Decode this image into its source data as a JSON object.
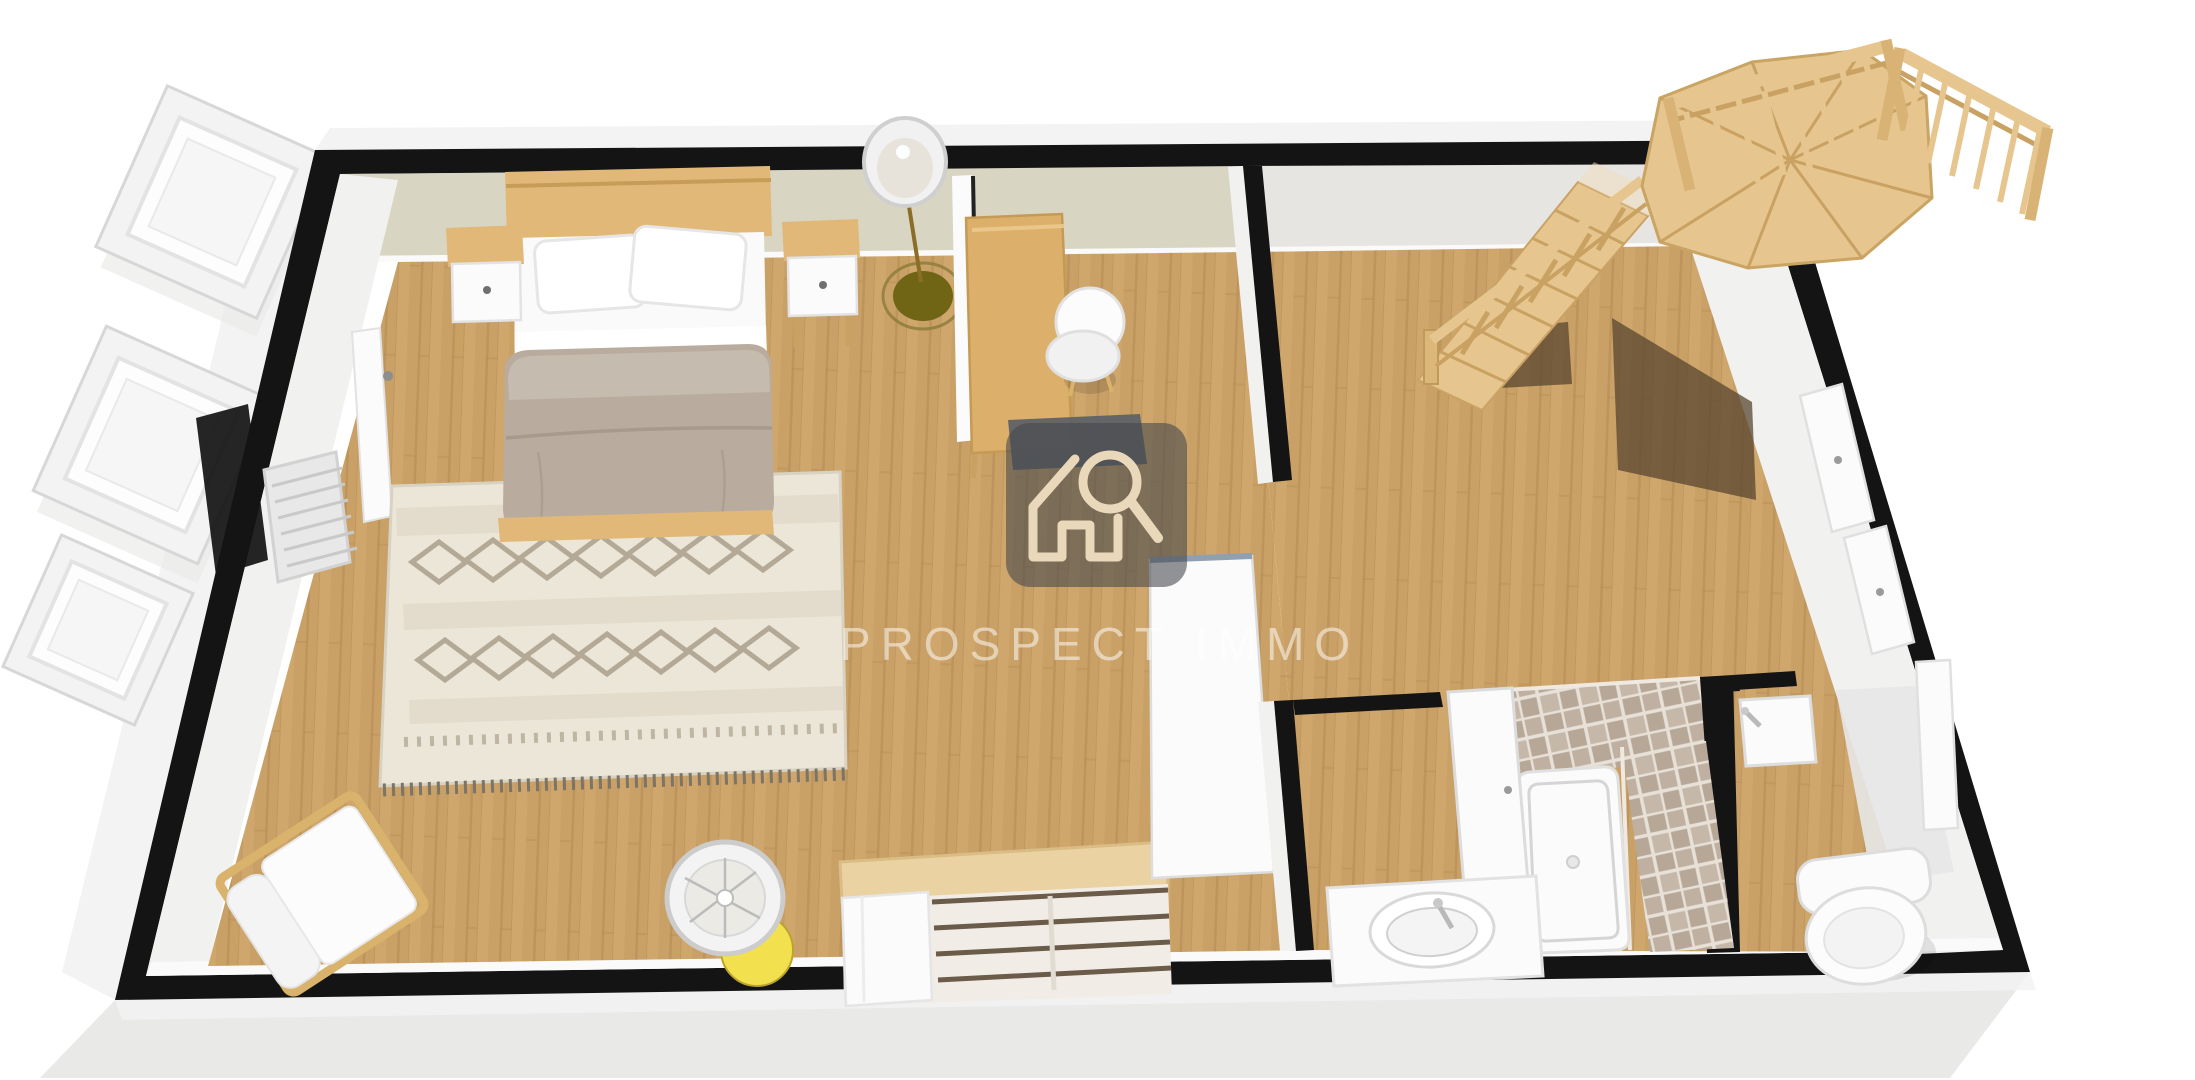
{
  "watermark": {
    "text": "PROSPECT IMMO",
    "icon": "house-magnifier-icon"
  },
  "colors": {
    "pageBg": "#ffffff",
    "wallCore": "#141414",
    "exteriorShadow": "#e9e9e8",
    "exteriorFace": "#f3f3f3",
    "bedroomWall": "#d9d5c3",
    "hallWall": "#e6e5e2",
    "wallFace": "#f1f1f0",
    "baseboard": "#fafafa",
    "floorWood": "#c9a066",
    "floorLight": "#d8b179",
    "floorSeam": "#ae854f",
    "rugBase": "#ece6d8",
    "rugMotif": "#b3a996",
    "rugDark": "#7c7466",
    "bedWood": "#e2b878",
    "bedWoodEdge": "#c79c59",
    "mattressWhite": "#fafafa",
    "duvetTaupe": "#b9ac9e",
    "stairWood": "#e6c68e",
    "stairEdge": "#c9a263",
    "stairShadow": "#58462f",
    "tileA": "#b6a797",
    "tileB": "#c6b8a9",
    "tileGrout": "#e8e1d8",
    "fixtureWhite": "#fbfbfb",
    "fixtureLine": "#dcdcdc",
    "chairWood": "#d9b36c",
    "lampGlow": "#f3e04e",
    "lampBase": "#6f6514",
    "matDark": "#5b6067",
    "watermarkBadge": "#44464c",
    "watermarkIcon": "#e9d8ba",
    "watermarkText": "#ffffff"
  },
  "scene": {
    "view": "3d-floorplan-top",
    "rooms": [
      {
        "name": "bedroom",
        "furniture": [
          "double-bed",
          "nightstand-left",
          "nightstand-right",
          "berber-rug",
          "desk",
          "desk-chair",
          "desk-mat",
          "open-door-leaf",
          "floor-lamp-tall",
          "floor-lamp-glow",
          "armchair",
          "open-wardrobe",
          "room-divider",
          "radiator",
          "entry-door"
        ]
      },
      {
        "name": "hallway-landing",
        "furniture": [
          "staircase-flight",
          "stair-railing",
          "stair-floor-shadows",
          "closet-doors-right-wall"
        ]
      },
      {
        "name": "bathroom",
        "furniture": [
          "shower-tiled-walls",
          "shower-tray",
          "vanity-sink",
          "bathroom-door-open"
        ]
      },
      {
        "name": "wc",
        "furniture": [
          "toilet",
          "hand-basin",
          "wc-door-open"
        ]
      }
    ],
    "exterior": [
      "open-window-panels-left",
      "upper-stair-winder-landing",
      "landing-railing-left",
      "landing-railing-right",
      "ground-shadow"
    ]
  }
}
